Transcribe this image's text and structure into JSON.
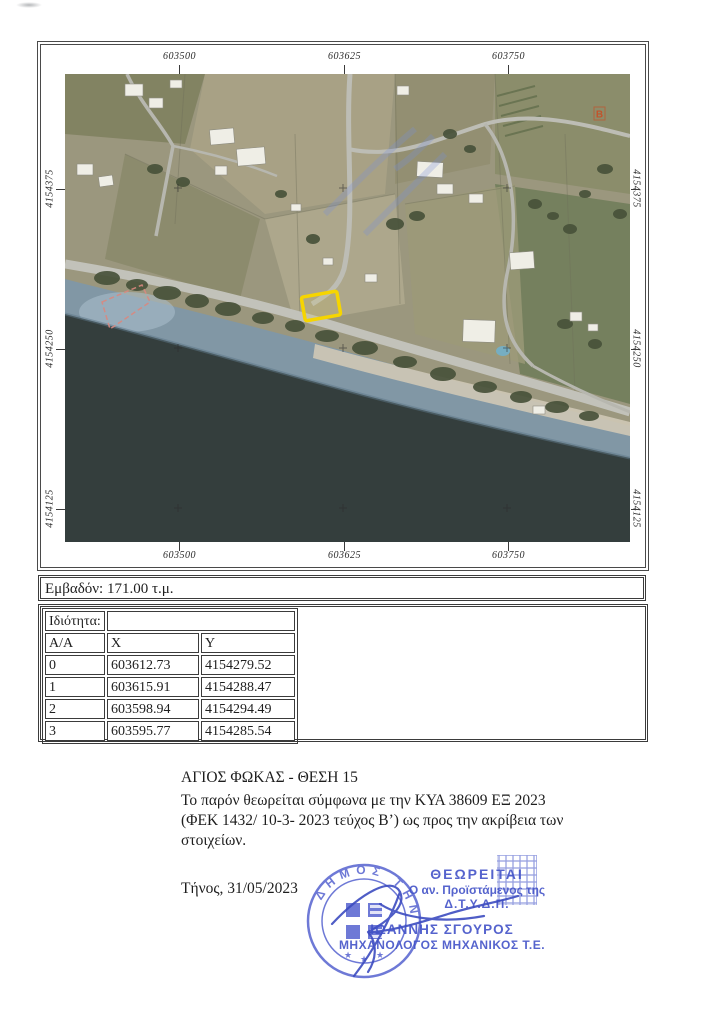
{
  "map": {
    "x_labels": [
      "603500",
      "603625",
      "603750"
    ],
    "y_labels": [
      "4154375",
      "4154250",
      "4154125"
    ],
    "marker_b": "B",
    "parcel_color": "#f6d500",
    "marker_color": "#c2532b"
  },
  "area": {
    "label": "Εμβαδόν: 171.00 τ.μ."
  },
  "table": {
    "property_label": "Ιδιότητα:",
    "property_value": "",
    "headers": [
      "Α/Α",
      "X",
      "Y"
    ],
    "rows": [
      {
        "id": "0",
        "x": "603612.73",
        "y": "4154279.52"
      },
      {
        "id": "1",
        "x": "603615.91",
        "y": "4154288.47"
      },
      {
        "id": "2",
        "x": "603598.94",
        "y": "4154294.49"
      },
      {
        "id": "3",
        "x": "603595.77",
        "y": "4154285.54"
      }
    ]
  },
  "notes": {
    "title": "ΑΓΙΟΣ ΦΩΚΑΣ - ΘΕΣΗ 15",
    "line1": "Το παρόν θεωρείται σύμφωνα με την ΚΥΑ 38609 ΕΞ 2023",
    "line2": "(ΦΕΚ 1432/ 10-3- 2023 τεύχος Β’) ως προς την ακρίβεια των",
    "line3": "στοιχείων.",
    "date": "Τήνος, 31/05/2023"
  },
  "stamp": {
    "approval": "ΘΕΩΡΕΙΤΑΙ",
    "line1": "Ο αν. Προϊστάμενος της",
    "line2": "Δ.Τ.Υ.Δ.Π.",
    "name": "ΙΩΑΝΝΗΣ ΣΓΟΥΡΟΣ",
    "title": "ΜΗΧΑΝΟΛΟΓΟΣ ΜΗΧΑΝΙΚΟΣ Τ.Ε.",
    "seal_text": "ΔΗΜΟΣ ΤΗΝΟΥ",
    "color": "#4353c8"
  }
}
